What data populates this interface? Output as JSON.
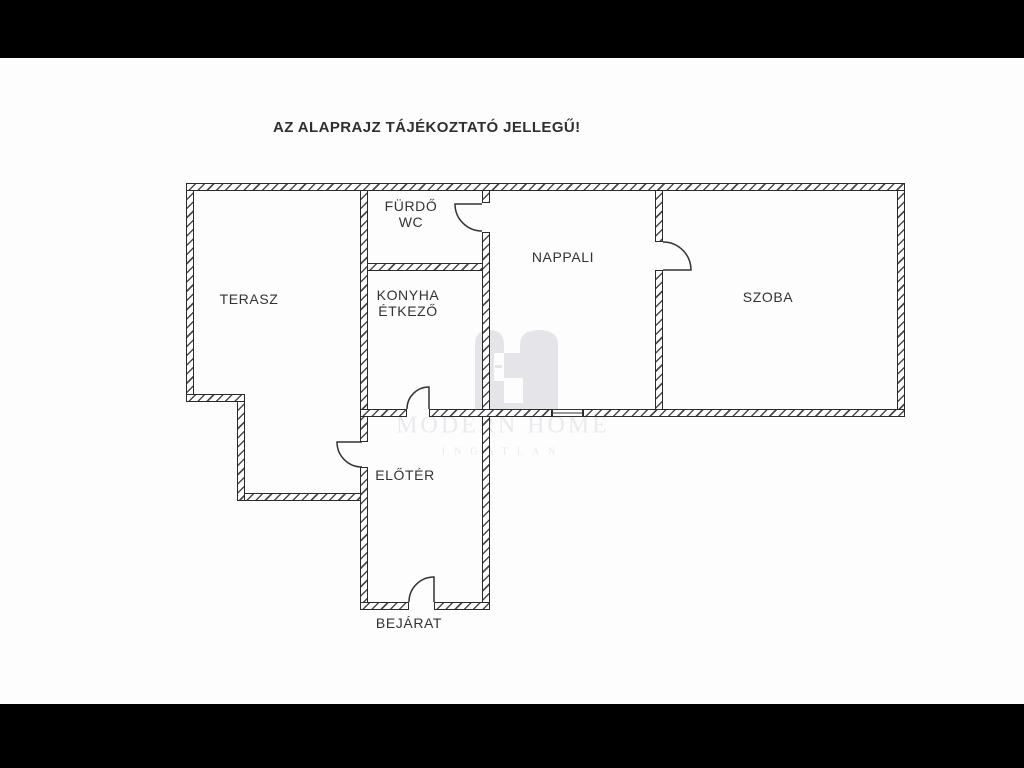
{
  "disclaimer": "AZ ALAPRAJZ TÁJÉKOZTATÓ JELLEGŰ!",
  "rooms": {
    "terasz": {
      "label": "TERASZ"
    },
    "furdo": {
      "label": "FÜRDŐ",
      "label2": "WC"
    },
    "konyha": {
      "label": "KONYHA",
      "label2": "ÉTKEZŐ"
    },
    "nappali": {
      "label": "NAPPALI"
    },
    "szoba": {
      "label": "SZOBA"
    },
    "eloter": {
      "label": "ELŐTÉR"
    },
    "bejarat": {
      "label": "BEJÁRAT"
    }
  },
  "watermark": {
    "brand": "MODERN HOME",
    "tagline": "INGATLAN"
  },
  "colors": {
    "wall_outline": "#2a2a2a",
    "wall_hatch": "#4a4a4a",
    "door_stroke": "#333333",
    "watermark_gray": "#e5e5e9",
    "label_text": "#333333",
    "letterbox": "#000000",
    "background": "#fdfdfd"
  }
}
